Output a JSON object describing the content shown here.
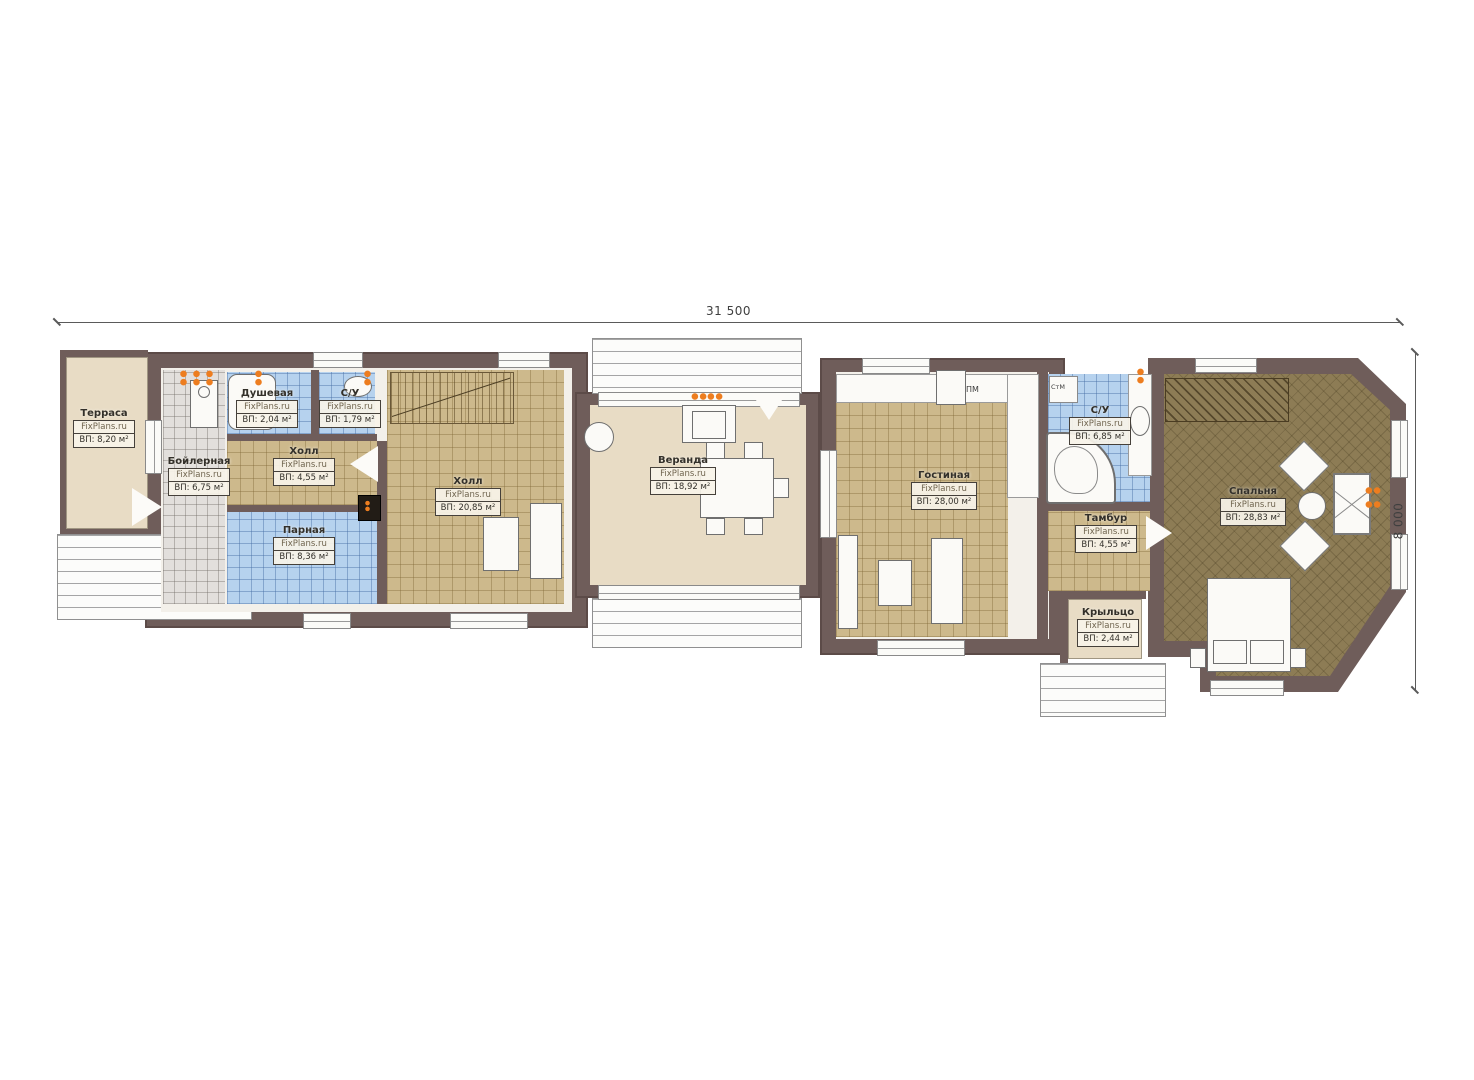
{
  "title": "План первого этажа",
  "brand": "FixPlans.ru",
  "dimensions": {
    "overall_width": "31 500",
    "overall_height": "8 000"
  },
  "rooms": [
    {
      "id": "terrasa",
      "name": "Терраса",
      "brand": "FixPlans.ru",
      "area": "ВП: 8,20 м²"
    },
    {
      "id": "boilernaya",
      "name": "Бойлерная",
      "brand": "FixPlans.ru",
      "area": "ВП: 6,75 м²"
    },
    {
      "id": "dushevaya",
      "name": "Душевая",
      "brand": "FixPlans.ru",
      "area": "ВП: 2,04 м²"
    },
    {
      "id": "su-1",
      "name": "С/У",
      "brand": "FixPlans.ru",
      "area": "ВП: 1,79 м²"
    },
    {
      "id": "holl-1",
      "name": "Холл",
      "brand": "FixPlans.ru",
      "area": "ВП: 4,55 м²"
    },
    {
      "id": "parnaya",
      "name": "Парная",
      "brand": "FixPlans.ru",
      "area": "ВП: 8,36 м²"
    },
    {
      "id": "holl-2",
      "name": "Холл",
      "brand": "FixPlans.ru",
      "area": "ВП: 20,85 м²"
    },
    {
      "id": "veranda",
      "name": "Веранда",
      "brand": "FixPlans.ru",
      "area": "ВП: 18,92 м²"
    },
    {
      "id": "gostinaya",
      "name": "Гостиная",
      "brand": "FixPlans.ru",
      "area": "ВП: 28,00 м²"
    },
    {
      "id": "su-2",
      "name": "С/У",
      "brand": "FixPlans.ru",
      "area": "ВП: 6,85 м²"
    },
    {
      "id": "tambur",
      "name": "Тамбур",
      "brand": "FixPlans.ru",
      "area": "ВП: 4,55 м²"
    },
    {
      "id": "kryltso",
      "name": "Крыльцо",
      "brand": "FixPlans.ru",
      "area": "ВП: 2,44 м²"
    },
    {
      "id": "spalnya",
      "name": "Спальня",
      "brand": "FixPlans.ru",
      "area": "ВП: 28,83 м²"
    }
  ],
  "appliances": {
    "dishwasher": "ПМ",
    "washer": "СтМ"
  },
  "colors": {
    "wall": "#6f5d5a",
    "tile_tan": "#cdb98c",
    "tile_blue": "#b6d2ee",
    "tile_gray": "#e2dfdc",
    "floor_beige": "#e8dcc5",
    "floor_olive": "#8d7c55",
    "radiator_orange": "#ed7d1f"
  }
}
